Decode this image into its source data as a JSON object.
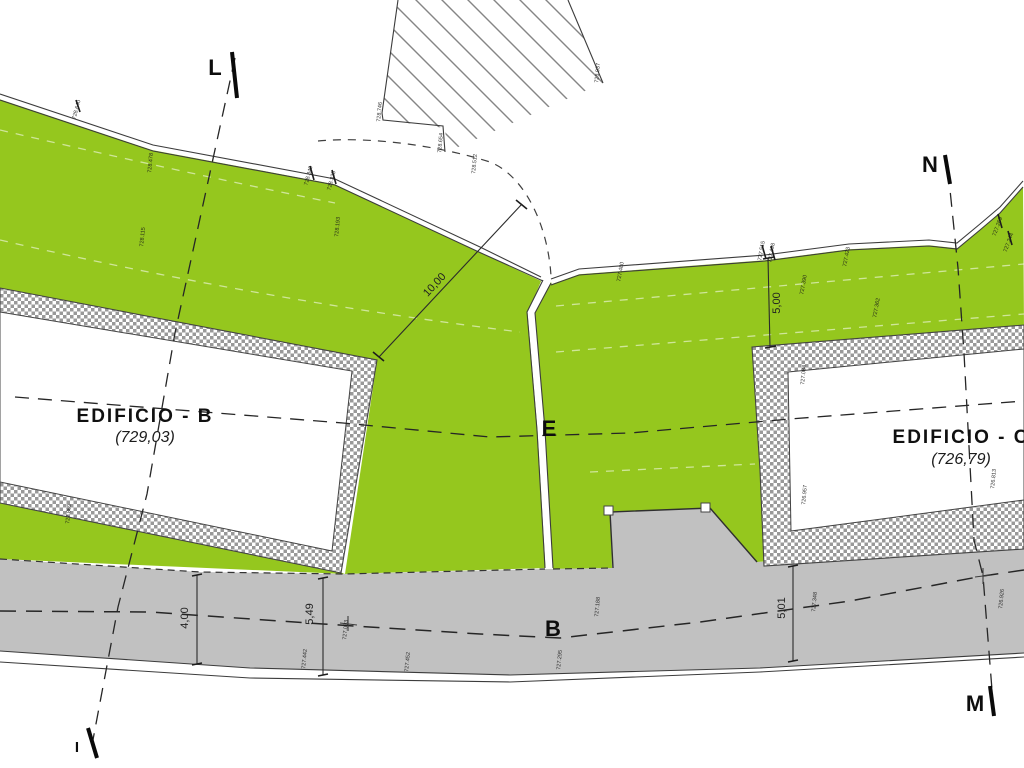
{
  "drawing": {
    "title": "Site plan with buildings B and C, green areas and road",
    "buildings": {
      "b": {
        "name": "EDIFICIO - B",
        "elevation": "(729,03)"
      },
      "c": {
        "name": "EDIFICIO - C",
        "elevation": "(726,79)"
      }
    },
    "section_markers": {
      "l": "L",
      "i": "I",
      "n": "N",
      "m": "M",
      "e": "E",
      "road_axis": "B"
    },
    "dimensions": {
      "d10": "10,00",
      "d5a": "5,00",
      "d4": "4,00",
      "d549": "5,49",
      "d501": "5,01"
    },
    "colors": {
      "green_area": "#95c71e",
      "road_gray": "#c1c1c1",
      "line_dark": "#333333",
      "hatch_line_gray": "#858585",
      "wall_checker_gray": "#999999"
    },
    "spot_elevations": [
      {
        "x": 78,
        "y": 110,
        "rot": -75,
        "text": "728.640"
      },
      {
        "x": 152,
        "y": 163,
        "rot": -85,
        "text": "728.478"
      },
      {
        "x": 144,
        "y": 237,
        "rot": -85,
        "text": "728.115"
      },
      {
        "x": 339,
        "y": 227,
        "rot": -85,
        "text": "728.193"
      },
      {
        "x": 310,
        "y": 176,
        "rot": -75,
        "text": "728.349"
      },
      {
        "x": 333,
        "y": 181,
        "rot": -75,
        "text": "728.325"
      },
      {
        "x": 381,
        "y": 112,
        "rot": -85,
        "text": "728.746"
      },
      {
        "x": 442,
        "y": 143,
        "rot": -85,
        "text": "728.654"
      },
      {
        "x": 476,
        "y": 164,
        "rot": -85,
        "text": "728.512"
      },
      {
        "x": 599,
        "y": 73,
        "rot": -85,
        "text": "728.937"
      },
      {
        "x": 763,
        "y": 251,
        "rot": -80,
        "text": "727.515"
      },
      {
        "x": 773,
        "y": 253,
        "rot": -80,
        "text": "727.498"
      },
      {
        "x": 848,
        "y": 257,
        "rot": -80,
        "text": "727.423"
      },
      {
        "x": 805,
        "y": 285,
        "rot": -80,
        "text": "727.390"
      },
      {
        "x": 999,
        "y": 227,
        "rot": -70,
        "text": "727.269"
      },
      {
        "x": 1010,
        "y": 243,
        "rot": -70,
        "text": "727.244"
      },
      {
        "x": 878,
        "y": 308,
        "rot": -80,
        "text": "727.362"
      },
      {
        "x": 622,
        "y": 272,
        "rot": -80,
        "text": "727.480"
      },
      {
        "x": 805,
        "y": 375,
        "rot": -85,
        "text": "727.084"
      },
      {
        "x": 806,
        "y": 495,
        "rot": -85,
        "text": "726.957"
      },
      {
        "x": 995,
        "y": 479,
        "rot": -85,
        "text": "726.813"
      },
      {
        "x": 70,
        "y": 514,
        "rot": -85,
        "text": "727.869"
      },
      {
        "x": 306,
        "y": 659,
        "rot": -85,
        "text": "727.442"
      },
      {
        "x": 347,
        "y": 630,
        "rot": -85,
        "text": "727.093"
      },
      {
        "x": 409,
        "y": 662,
        "rot": -85,
        "text": "727.452"
      },
      {
        "x": 561,
        "y": 660,
        "rot": -85,
        "text": "727.295"
      },
      {
        "x": 599,
        "y": 607,
        "rot": -85,
        "text": "727.188"
      },
      {
        "x": 816,
        "y": 602,
        "rot": -85,
        "text": "727.348"
      },
      {
        "x": 1003,
        "y": 599,
        "rot": -85,
        "text": "726.926"
      }
    ]
  }
}
